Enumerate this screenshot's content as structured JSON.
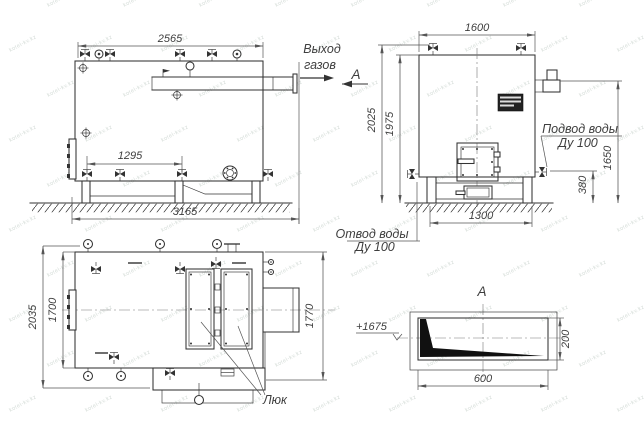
{
  "watermark": "kotel-kv.kz",
  "colors": {
    "line": "#333333",
    "dim": "#555555",
    "fill": "#111111",
    "watermark": "#becac3"
  },
  "side_view": {
    "dim_width": "2565",
    "dim_valves": "1295",
    "dim_length": "3165",
    "gas_outlet_line1": "Выход",
    "gas_outlet_line2": "газов",
    "section_mark": "А"
  },
  "front_view": {
    "dim_width": "1600",
    "dim_height_overall": "2025",
    "dim_height_body": "1975",
    "dim_chimney": "1650",
    "dim_outlet_height": "380",
    "dim_base": "1300",
    "water_inlet_line1": "Подвод воды",
    "water_inlet_line2": "Ду 100",
    "water_outlet_line1": "Отвод воды",
    "water_outlet_line2": "Ду 100"
  },
  "top_view": {
    "dim_width_overall": "2035",
    "dim_width_body": "1700",
    "dim_depth": "1770",
    "hatch_label": "Люк"
  },
  "section_a": {
    "title": "А",
    "elevation": "+1675",
    "dim_height": "200",
    "dim_width": "600"
  }
}
